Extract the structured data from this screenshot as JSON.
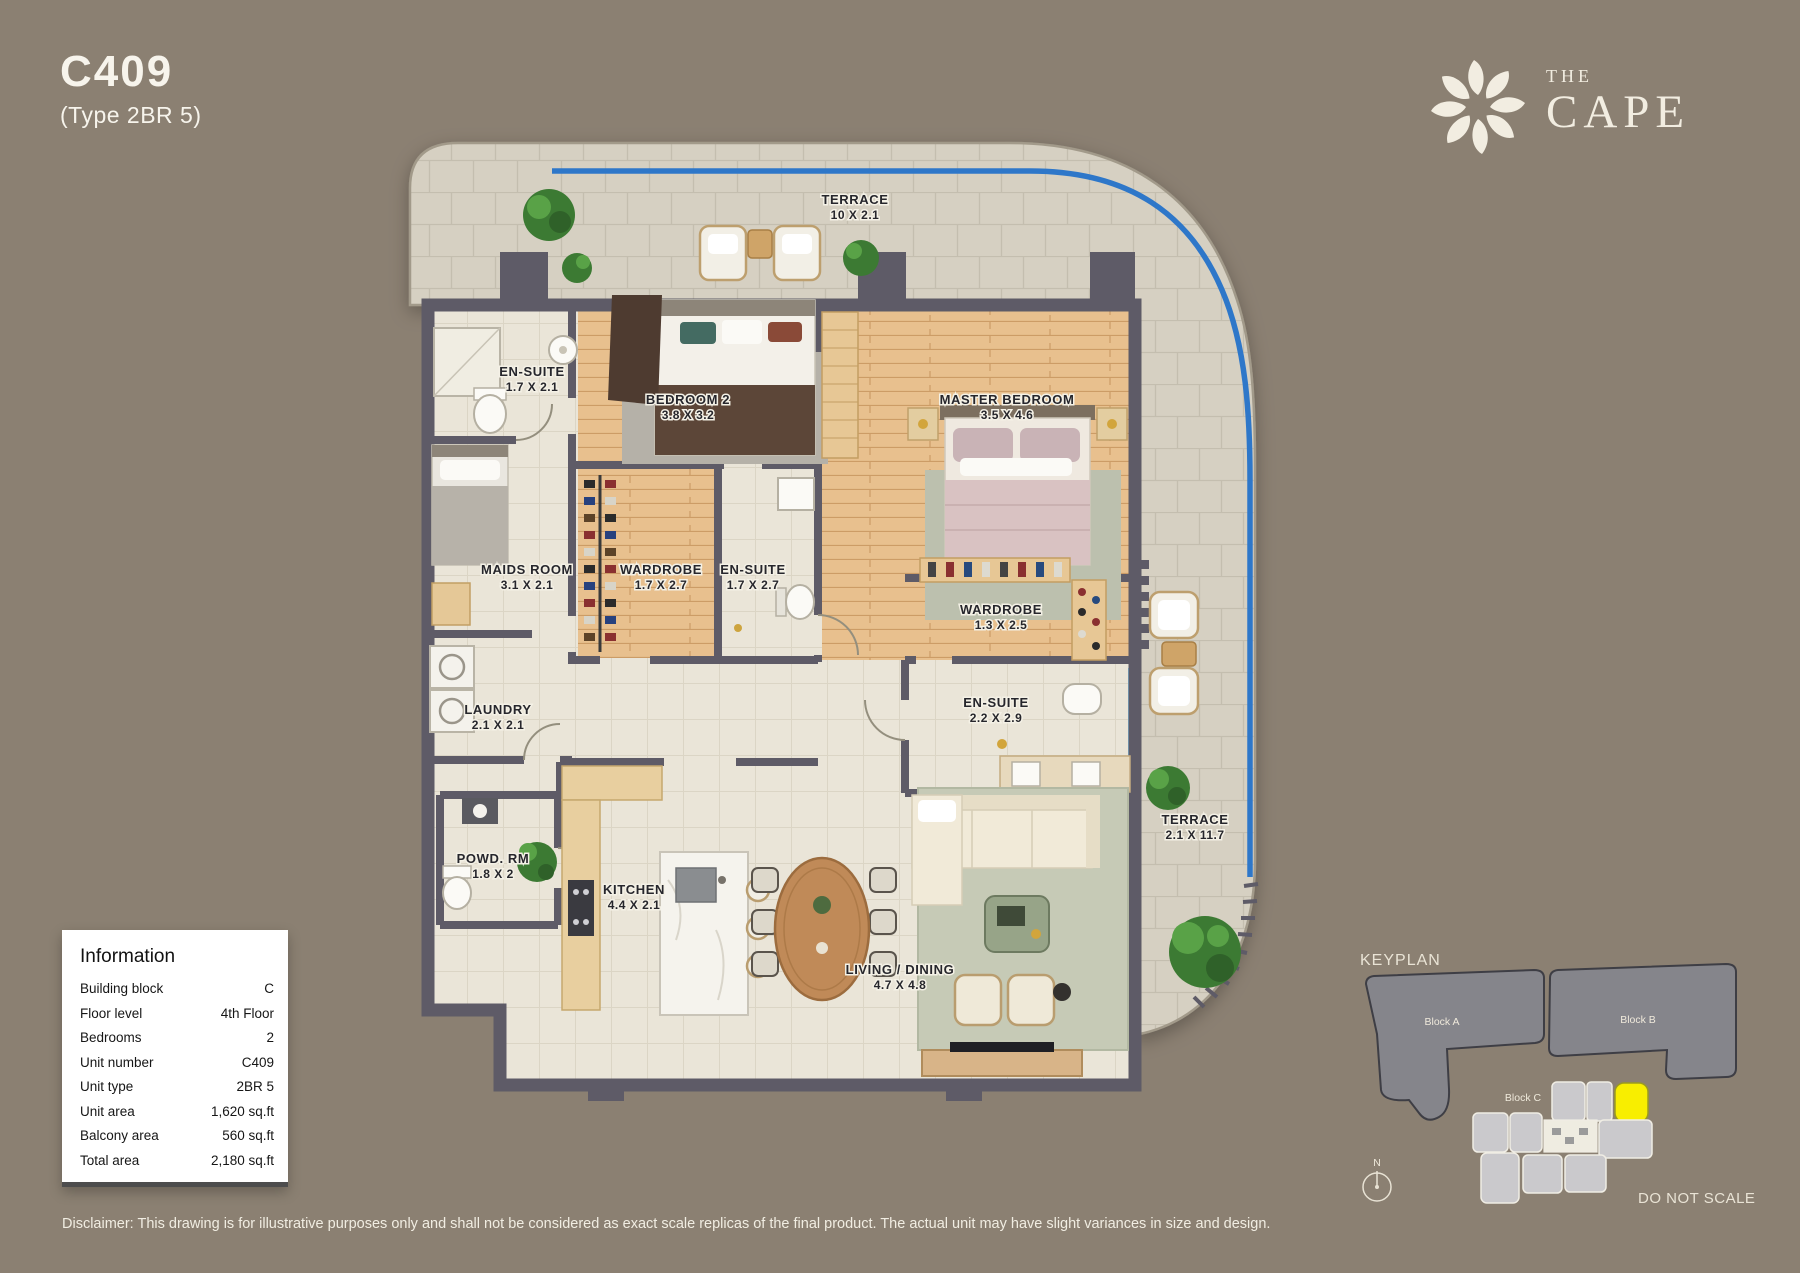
{
  "header": {
    "unit_code": "C409",
    "unit_type": "(Type 2BR 5)"
  },
  "brand": {
    "name_top": "THE",
    "name_bottom": "CAPE"
  },
  "floorplan": {
    "rooms": [
      {
        "name": "TERRACE",
        "dims": "10 X 2.1"
      },
      {
        "name": "EN-SUITE",
        "dims": "1.7 X 2.1"
      },
      {
        "name": "BEDROOM 2",
        "dims": "3.8 X 3.2"
      },
      {
        "name": "MASTER BEDROOM",
        "dims": "3.5 X 4.6"
      },
      {
        "name": "MAIDS ROOM",
        "dims": "3.1 X 2.1"
      },
      {
        "name": "WARDROBE",
        "dims": "1.7 X 2.7"
      },
      {
        "name": "EN-SUITE",
        "dims": "1.7 X 2.7"
      },
      {
        "name": "WARDROBE",
        "dims": "1.3 X 2.5"
      },
      {
        "name": "EN-SUITE",
        "dims": "2.2 X 2.9"
      },
      {
        "name": "LAUNDRY",
        "dims": "2.1 X 2.1"
      },
      {
        "name": "POWD. RM",
        "dims": "1.8 X 2"
      },
      {
        "name": "KITCHEN",
        "dims": "4.4 X 2.1"
      },
      {
        "name": "LIVING / DINING",
        "dims": "4.7 X 4.8"
      },
      {
        "name": "TERRACE",
        "dims": "2.1 X 11.7"
      }
    ],
    "colors": {
      "background": "#8b8072",
      "wall": "#5e5b67",
      "terrace_tile": "#d6d0c2",
      "interior_tile": "#eae5d8",
      "wood": "#e8c08e",
      "balustrade_blue": "#2e77c9"
    }
  },
  "information": {
    "title": "Information",
    "rows": [
      {
        "label": "Building block",
        "value": "C"
      },
      {
        "label": "Floor level",
        "value": "4th Floor"
      },
      {
        "label": "Bedrooms",
        "value": "2"
      },
      {
        "label": "Unit number",
        "value": "C409"
      },
      {
        "label": "Unit type",
        "value": "2BR 5"
      },
      {
        "label": "Unit area",
        "value": "1,620 sq.ft"
      },
      {
        "label": "Balcony area",
        "value": "560 sq.ft"
      },
      {
        "label": "Total area",
        "value": "2,180 sq.ft"
      }
    ]
  },
  "keyplan": {
    "title": "KEYPLAN",
    "blocks": [
      {
        "label": "Block A"
      },
      {
        "label": "Block B"
      },
      {
        "label": "Block C"
      }
    ],
    "compass": "N",
    "note": "DO NOT SCALE",
    "highlight_color": "#f8ee00"
  },
  "disclaimer": "Disclaimer: This drawing is for illustrative purposes only and shall not be considered as exact scale replicas of the final product. The actual unit may have slight variances in size and design."
}
